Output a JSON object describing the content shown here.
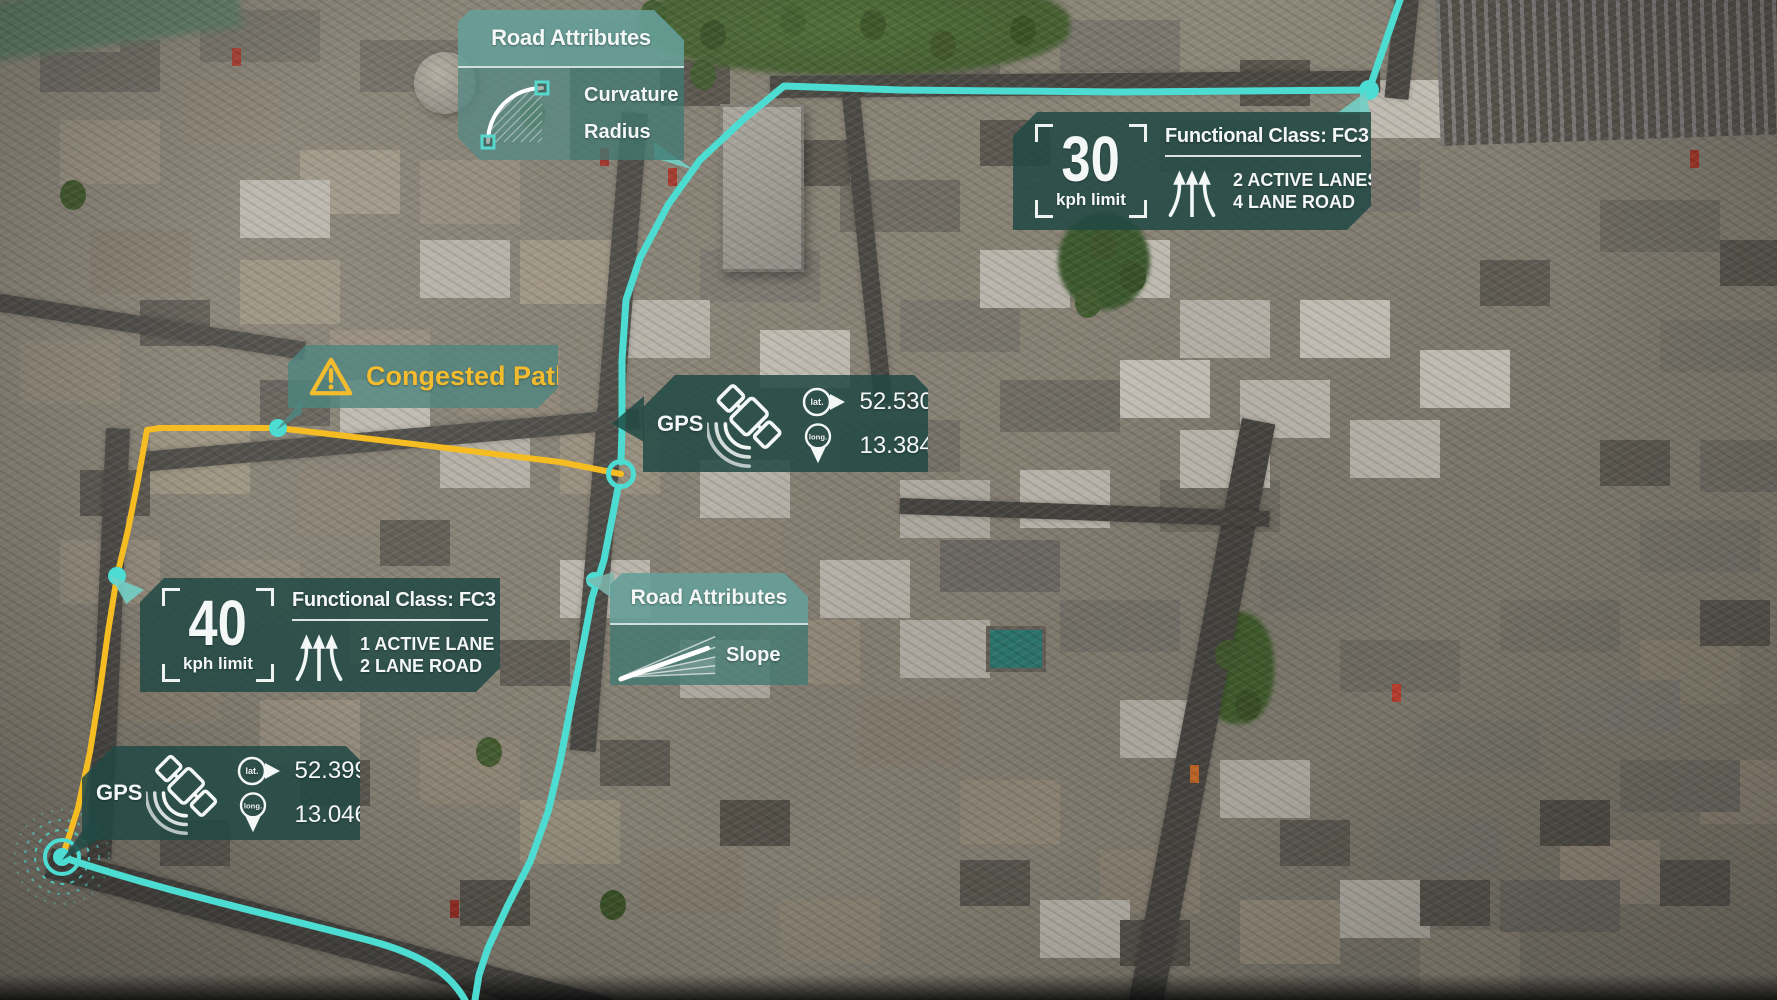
{
  "colors": {
    "route_active": "#4ddcd1",
    "route_congested": "#f5bd22",
    "panel_dark_teal": "rgba(33,73,68,0.85)",
    "panel_light_teal": "rgba(104,168,160,0.8)",
    "warning_yellow": "#f3bc2e",
    "text_light": "#f3f7f6"
  },
  "overlay": {
    "road_attributes_top": {
      "title": "Road Attributes",
      "items": [
        "Curvature",
        "Radius"
      ],
      "icon": "curvature-arc-icon"
    },
    "speed_panel_top": {
      "speed_value": "30",
      "speed_unit": "kph limit",
      "class_title": "Functional Class: FC3",
      "lane_info": [
        "2 ACTIVE LANES",
        "4 LANE ROAD"
      ],
      "icon": "lane-arrows-icon"
    },
    "congested_path": {
      "label": "Congested Path",
      "icon": "warning-triangle-icon"
    },
    "gps_center": {
      "label": "GPS",
      "lat_label": "lat.",
      "lat_value": "52.530935",
      "long_label": "long.",
      "long_value": "13.384933",
      "icon": "satellite-icon"
    },
    "speed_panel_left": {
      "speed_value": "40",
      "speed_unit": "kph limit",
      "class_title": "Functional Class: FC3",
      "lane_info": [
        "1 ACTIVE LANE",
        "2 LANE ROAD"
      ],
      "icon": "lane-arrows-icon"
    },
    "road_attributes_slope": {
      "title": "Road Attributes",
      "items": [
        "Slope"
      ],
      "icon": "slope-fan-icon"
    },
    "gps_bottom": {
      "label": "GPS",
      "lat_label": "lat.",
      "lat_value": "52.399517",
      "long_label": "long.",
      "long_value": "13.046078",
      "icon": "satellite-icon"
    }
  }
}
